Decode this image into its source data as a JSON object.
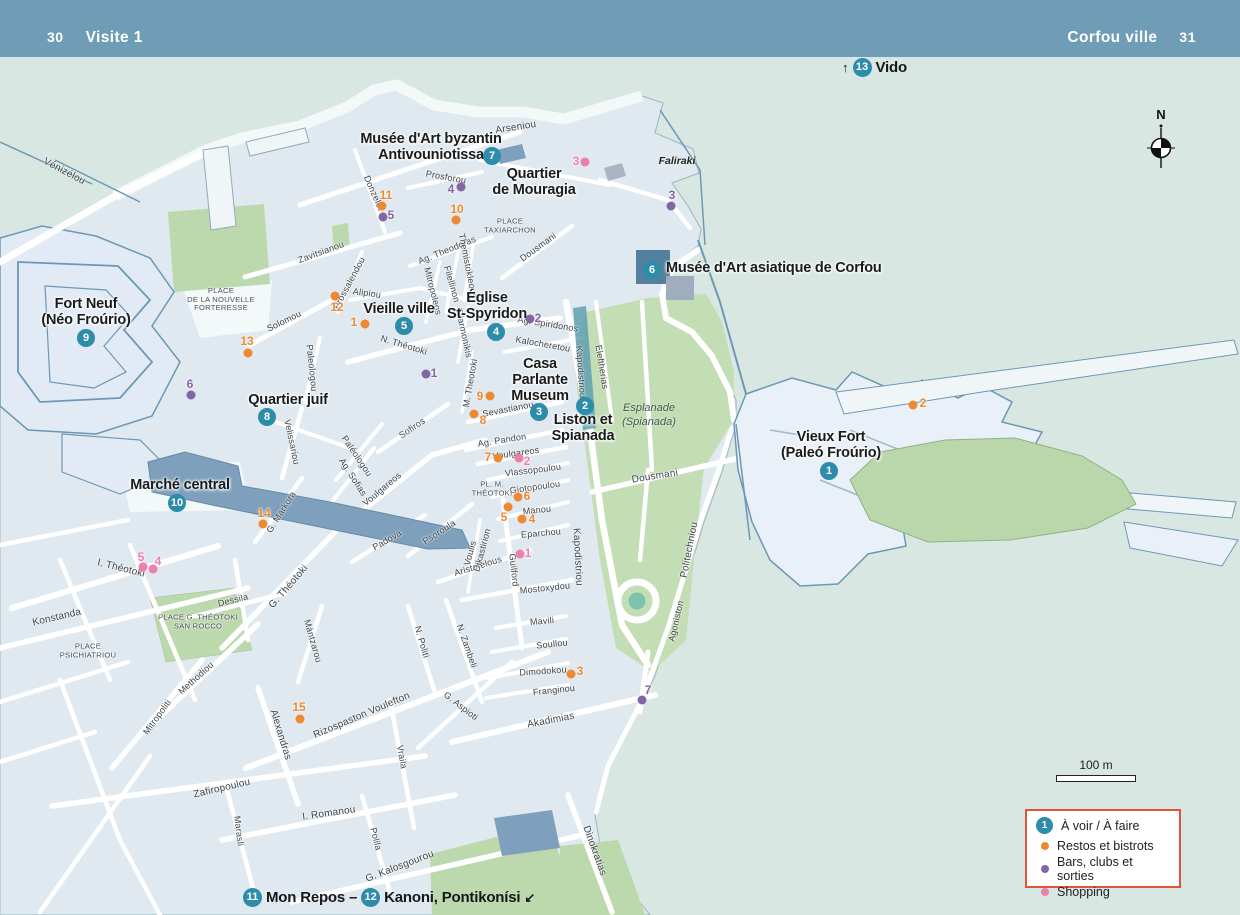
{
  "header": {
    "page_left": "30",
    "title_left": "Visite 1",
    "title_right": "Corfou ville",
    "page_right": "31"
  },
  "compass": {
    "north_label": "N"
  },
  "scale_bar": {
    "label": "100 m"
  },
  "legend": {
    "see_do": {
      "number": "1",
      "label": "À voir / À faire"
    },
    "items": [
      {
        "color": "#ee8931",
        "label": "Restos et bistrots"
      },
      {
        "color": "#8465a5",
        "label": "Bars, clubs et sorties"
      },
      {
        "color": "#ee7fa9",
        "label": "Shopping"
      }
    ]
  },
  "links": {
    "vido": {
      "arrow": "↑",
      "number": "13",
      "label": "Vido"
    },
    "bottom": {
      "n1": "11",
      "label1": "Mon Repos –",
      "n2": "12",
      "label2": "Kanoni, Pontikonísi",
      "arrow": "↙"
    }
  },
  "colors": {
    "header": "#6f9db6",
    "sea": "#d8e7e2",
    "land_block": "#e0e9ef",
    "street": "#ffffff",
    "park": "#bcd9ae",
    "esplanade": "#c3ddb4",
    "fort_fill": "#e9f0f7",
    "fort_stroke": "#6d98b4",
    "building": "#7fa0bc",
    "museum_building": "#54809f",
    "teal_poi": "#2d8ca9",
    "restos": "#ee8931",
    "bars": "#8465a5",
    "shopping": "#ee7fa9",
    "legend_border": "#df5438"
  },
  "pois": [
    {
      "lines": [
        "Musée d'Art byzantin",
        "Antivouniotissa"
      ],
      "x": 431,
      "y": 147
    },
    {
      "lines": [
        "Quartier",
        "de Mouragia"
      ],
      "x": 534,
      "y": 182
    },
    {
      "lines": [
        "Fort Neuf",
        "(Néo Froúrio)"
      ],
      "x": 86,
      "y": 312
    },
    {
      "lines": [
        "Vieille ville"
      ],
      "x": 399,
      "y": 309
    },
    {
      "lines": [
        "Église",
        "St-Spyridon"
      ],
      "x": 487,
      "y": 306
    },
    {
      "lines": [
        "Casa",
        "Parlante",
        "Museum"
      ],
      "x": 540,
      "y": 380
    },
    {
      "lines": [
        "Liston et",
        "Spianada"
      ],
      "x": 583,
      "y": 428
    },
    {
      "lines": [
        "Musée d'Art asiatique de Corfou"
      ],
      "x": 666,
      "y": 268,
      "anchor": "left"
    },
    {
      "lines": [
        "Vieux Fort",
        "(Paleó Froúrio)"
      ],
      "x": 831,
      "y": 445
    },
    {
      "lines": [
        "Quartier juif"
      ],
      "x": 288,
      "y": 400
    },
    {
      "lines": [
        "Marché central"
      ],
      "x": 180,
      "y": 485
    }
  ],
  "poi_circles": [
    {
      "n": "1",
      "x": 829,
      "y": 471
    },
    {
      "n": "2",
      "x": 585,
      "y": 406
    },
    {
      "n": "3",
      "x": 539,
      "y": 412
    },
    {
      "n": "4",
      "x": 496,
      "y": 332
    },
    {
      "n": "5",
      "x": 404,
      "y": 326
    },
    {
      "n": "6",
      "x": 652,
      "y": 270
    },
    {
      "n": "7",
      "x": 492,
      "y": 156
    },
    {
      "n": "8",
      "x": 267,
      "y": 417
    },
    {
      "n": "9",
      "x": 86,
      "y": 338
    },
    {
      "n": "10",
      "x": 177,
      "y": 503
    }
  ],
  "markers": [
    {
      "n": "11",
      "c": "o",
      "dx": 382,
      "dy": 206,
      "tx": 386,
      "ty": 195
    },
    {
      "n": "10",
      "c": "o",
      "dx": 456,
      "dy": 220,
      "tx": 457,
      "ty": 209
    },
    {
      "n": "1",
      "c": "o",
      "dx": 365,
      "dy": 324,
      "tx": 354,
      "ty": 322
    },
    {
      "n": "12",
      "c": "o",
      "dx": 335,
      "dy": 296,
      "tx": 337,
      "ty": 307
    },
    {
      "n": "13",
      "c": "o",
      "dx": 248,
      "dy": 353,
      "tx": 247,
      "ty": 341
    },
    {
      "n": "9",
      "c": "o",
      "dx": 490,
      "dy": 396,
      "tx": 480,
      "ty": 396
    },
    {
      "n": "8",
      "c": "o",
      "dx": 474,
      "dy": 414,
      "tx": 483,
      "ty": 420
    },
    {
      "n": "7",
      "c": "o",
      "dx": 498,
      "dy": 458,
      "tx": 488,
      "ty": 457
    },
    {
      "n": "6",
      "c": "o",
      "dx": 518,
      "dy": 497,
      "tx": 527,
      "ty": 496
    },
    {
      "n": "5",
      "c": "o",
      "dx": 508,
      "dy": 507,
      "tx": 504,
      "ty": 517
    },
    {
      "n": "4",
      "c": "o",
      "dx": 522,
      "dy": 519,
      "tx": 532,
      "ty": 519
    },
    {
      "n": "3",
      "c": "o",
      "dx": 571,
      "dy": 674,
      "tx": 580,
      "ty": 671
    },
    {
      "n": "14",
      "c": "o",
      "dx": 263,
      "dy": 524,
      "tx": 264,
      "ty": 513
    },
    {
      "n": "15",
      "c": "o",
      "dx": 300,
      "dy": 719,
      "tx": 299,
      "ty": 707
    },
    {
      "n": "2",
      "c": "o",
      "dx": 913,
      "dy": 405,
      "tx": 923,
      "ty": 403
    },
    {
      "n": "5",
      "c": "v",
      "dx": 383,
      "dy": 217,
      "tx": 391,
      "ty": 215
    },
    {
      "n": "4",
      "c": "v",
      "dx": 461,
      "dy": 187,
      "tx": 451,
      "ty": 189
    },
    {
      "n": "3",
      "c": "v",
      "dx": 671,
      "dy": 206,
      "tx": 672,
      "ty": 195
    },
    {
      "n": "2",
      "c": "v",
      "dx": 530,
      "dy": 319,
      "tx": 538,
      "ty": 318
    },
    {
      "n": "1",
      "c": "v",
      "dx": 426,
      "dy": 374,
      "tx": 434,
      "ty": 373
    },
    {
      "n": "6",
      "c": "v",
      "dx": 191,
      "dy": 395,
      "tx": 190,
      "ty": 384
    },
    {
      "n": "7",
      "c": "v",
      "dx": 642,
      "dy": 700,
      "tx": 648,
      "ty": 690
    },
    {
      "n": "3",
      "c": "k",
      "dx": 585,
      "dy": 162,
      "tx": 576,
      "ty": 161
    },
    {
      "n": "2",
      "c": "k",
      "dx": 519,
      "dy": 458,
      "tx": 527,
      "ty": 461
    },
    {
      "n": "1",
      "c": "k",
      "dx": 520,
      "dy": 554,
      "tx": 528,
      "ty": 553
    },
    {
      "n": "5",
      "c": "k",
      "dx": 143,
      "dy": 567,
      "tx": 141,
      "ty": 557
    },
    {
      "n": "4",
      "c": "k",
      "dx": 153,
      "dy": 569,
      "tx": 158,
      "ty": 561
    }
  ],
  "places": [
    {
      "lines": [
        "PLACE",
        "TAXIARCHON"
      ],
      "x": 510,
      "y": 226
    },
    {
      "lines": [
        "PLACE",
        "DE LA NOUVELLE",
        "FORTERESSE"
      ],
      "x": 221,
      "y": 300
    },
    {
      "lines": [
        "PLACE G. THÉOTOKI",
        "SAN ROCCO"
      ],
      "x": 198,
      "y": 622
    },
    {
      "lines": [
        "PLACE",
        "PSICHIATRIOU"
      ],
      "x": 88,
      "y": 651
    },
    {
      "lines": [
        "PL. M.",
        "THÉOTOKI"
      ],
      "x": 492,
      "y": 489
    }
  ],
  "areas": [
    {
      "lines": [
        "Faliraki"
      ],
      "x": 677,
      "y": 161,
      "cls": "dark"
    },
    {
      "lines": [
        "Esplanade",
        "(Spianada)"
      ],
      "x": 649,
      "y": 415
    }
  ],
  "streets": [
    {
      "t": "Arseniou",
      "x": 516,
      "y": 128,
      "r": -9,
      "s": 10
    },
    {
      "t": "Vénizélou",
      "x": 64,
      "y": 172,
      "r": 28,
      "s": 10
    },
    {
      "t": "Donzelot",
      "x": 374,
      "y": 193,
      "r": 66
    },
    {
      "t": "Prosforou",
      "x": 446,
      "y": 177,
      "r": 10
    },
    {
      "t": "Ag. Theodoras",
      "x": 447,
      "y": 250,
      "r": -22
    },
    {
      "t": "Zavitsianou",
      "x": 321,
      "y": 252,
      "r": -20
    },
    {
      "t": "Prossalendou",
      "x": 349,
      "y": 283,
      "r": -62
    },
    {
      "t": "Alipiou",
      "x": 367,
      "y": 293,
      "r": 8
    },
    {
      "t": "Solomou",
      "x": 284,
      "y": 321,
      "r": -26
    },
    {
      "t": "Filellinon",
      "x": 452,
      "y": 284,
      "r": 74
    },
    {
      "t": "Themistokleous",
      "x": 468,
      "y": 266,
      "r": 79
    },
    {
      "t": "Dousmani",
      "x": 538,
      "y": 247,
      "r": -36
    },
    {
      "t": "Mitropoleos",
      "x": 433,
      "y": 291,
      "r": 76
    },
    {
      "t": "N. Théotoki",
      "x": 404,
      "y": 345,
      "r": 17
    },
    {
      "t": "Ag. Spiridonos",
      "x": 548,
      "y": 324,
      "r": 9
    },
    {
      "t": "Kalocheretou",
      "x": 543,
      "y": 344,
      "r": 10
    },
    {
      "t": "Kapodistriou",
      "x": 581,
      "y": 372,
      "r": 86
    },
    {
      "t": "Eleftherias",
      "x": 602,
      "y": 367,
      "r": 81
    },
    {
      "t": "Filarmonikis",
      "x": 464,
      "y": 333,
      "r": 78
    },
    {
      "t": "M. Theotoki",
      "x": 470,
      "y": 383,
      "r": -80
    },
    {
      "t": "Sevastianou",
      "x": 508,
      "y": 409,
      "r": -11
    },
    {
      "t": "Ag. Pandon",
      "x": 502,
      "y": 440,
      "r": -9
    },
    {
      "t": "Voulgareos",
      "x": 516,
      "y": 453,
      "r": -8
    },
    {
      "t": "Vlassopoulou",
      "x": 533,
      "y": 470,
      "r": -7
    },
    {
      "t": "Giotopoulou",
      "x": 535,
      "y": 487,
      "r": -8
    },
    {
      "t": "Manou",
      "x": 537,
      "y": 510,
      "r": -6
    },
    {
      "t": "Eparchou",
      "x": 541,
      "y": 533,
      "r": -5
    },
    {
      "t": "Aristotelous",
      "x": 478,
      "y": 566,
      "r": -17
    },
    {
      "t": "Guilford",
      "x": 514,
      "y": 570,
      "r": 84
    },
    {
      "t": "Mostoxydou",
      "x": 545,
      "y": 588,
      "r": -6
    },
    {
      "t": "Dousmani",
      "x": 655,
      "y": 477,
      "r": -9,
      "s": 10
    },
    {
      "t": "Kapodistriou",
      "x": 577,
      "y": 557,
      "r": 87,
      "s": 10
    },
    {
      "t": "Politechniou",
      "x": 690,
      "y": 550,
      "r": -79,
      "s": 10
    },
    {
      "t": "Agoniston",
      "x": 676,
      "y": 621,
      "r": -77
    },
    {
      "t": "Voulis",
      "x": 470,
      "y": 553,
      "r": -75
    },
    {
      "t": "Dikastirion",
      "x": 482,
      "y": 550,
      "r": -75
    },
    {
      "t": "Psoroula",
      "x": 439,
      "y": 532,
      "r": -33
    },
    {
      "t": "Padova",
      "x": 387,
      "y": 540,
      "r": -30
    },
    {
      "t": "Sofiros",
      "x": 412,
      "y": 428,
      "r": -34
    },
    {
      "t": "Paléologou",
      "x": 357,
      "y": 456,
      "r": 56
    },
    {
      "t": "Paleologou",
      "x": 312,
      "y": 368,
      "r": 84
    },
    {
      "t": "Ag. Sofias",
      "x": 353,
      "y": 477,
      "r": 57
    },
    {
      "t": "Velissariou",
      "x": 292,
      "y": 442,
      "r": 78
    },
    {
      "t": "Voulgareos",
      "x": 382,
      "y": 489,
      "r": -40
    },
    {
      "t": "G. Markora",
      "x": 281,
      "y": 512,
      "r": -58
    },
    {
      "t": "I. Théotoki",
      "x": 121,
      "y": 569,
      "r": 14,
      "s": 10
    },
    {
      "t": "G. Théotoki",
      "x": 289,
      "y": 587,
      "r": -49,
      "s": 10
    },
    {
      "t": "Dessila",
      "x": 233,
      "y": 600,
      "r": -14
    },
    {
      "t": "Mántzarou",
      "x": 313,
      "y": 641,
      "r": 74
    },
    {
      "t": "Konstanda",
      "x": 57,
      "y": 618,
      "r": -13,
      "s": 10
    },
    {
      "t": "Methodiou",
      "x": 196,
      "y": 678,
      "r": -42
    },
    {
      "t": "Mitropoliti",
      "x": 157,
      "y": 717,
      "r": -54
    },
    {
      "t": "Alexandras",
      "x": 280,
      "y": 735,
      "r": 73,
      "s": 10
    },
    {
      "t": "Rizospaston Voulefton",
      "x": 362,
      "y": 716,
      "r": -23,
      "s": 10
    },
    {
      "t": "Vraila",
      "x": 402,
      "y": 757,
      "r": 80
    },
    {
      "t": "I. Romanou",
      "x": 329,
      "y": 814,
      "r": -8,
      "s": 10
    },
    {
      "t": "Marasli",
      "x": 239,
      "y": 831,
      "r": 83
    },
    {
      "t": "Polila",
      "x": 376,
      "y": 839,
      "r": 76
    },
    {
      "t": "G. Kalosgourou",
      "x": 400,
      "y": 867,
      "r": -21,
      "s": 10
    },
    {
      "t": "Zafiropoulou",
      "x": 222,
      "y": 789,
      "r": -13,
      "s": 10
    },
    {
      "t": "N. Politi",
      "x": 422,
      "y": 642,
      "r": 74
    },
    {
      "t": "N. Zambeli",
      "x": 467,
      "y": 646,
      "r": 71
    },
    {
      "t": "G. Aspioti",
      "x": 461,
      "y": 706,
      "r": 38
    },
    {
      "t": "Akadimias",
      "x": 551,
      "y": 721,
      "r": -11,
      "s": 10
    },
    {
      "t": "Franginou",
      "x": 554,
      "y": 690,
      "r": -6
    },
    {
      "t": "Dimodokou",
      "x": 543,
      "y": 671,
      "r": -4
    },
    {
      "t": "Soullou",
      "x": 552,
      "y": 644,
      "r": -6
    },
    {
      "t": "Mavili",
      "x": 542,
      "y": 621,
      "r": -5
    },
    {
      "t": "Dinokratias",
      "x": 594,
      "y": 851,
      "r": 70,
      "s": 10
    }
  ]
}
